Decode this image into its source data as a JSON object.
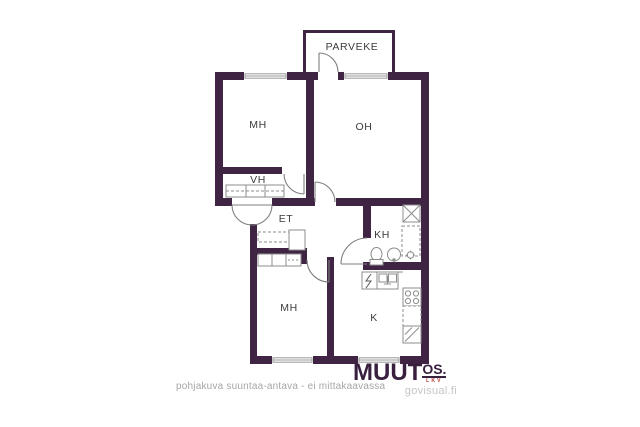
{
  "floor_plan": {
    "rooms": [
      {
        "key": "parveke",
        "label": "PARVEKE"
      },
      {
        "key": "mh_top",
        "label": "MH"
      },
      {
        "key": "oh",
        "label": "OH"
      },
      {
        "key": "vh",
        "label": "VH"
      },
      {
        "key": "et",
        "label": "ET"
      },
      {
        "key": "kh",
        "label": "KH"
      },
      {
        "key": "mh_bottom",
        "label": "MH"
      },
      {
        "key": "k",
        "label": "K"
      }
    ],
    "colors": {
      "wall": "#3f2543",
      "fixture_line": "#8c8c8c",
      "door_line": "#7f7f7f",
      "label": "#3c3c3c"
    },
    "fixture_icons": [
      "wardrobe-icon",
      "entry-door-arc",
      "door-arc",
      "window-symbol",
      "washing-machine-icon",
      "toilet-icon",
      "sink-icon",
      "floor-drain-icon",
      "electrical-cabinet-icon",
      "kitchen-sink-icon",
      "stove-icon",
      "refrigerator-icon"
    ]
  },
  "footer": {
    "disclaimer": "pohjakuva suuntaa-antava - ei mittakaavassa",
    "disclaimer_color": "#a8a4a8"
  },
  "branding": {
    "logo_text": "MUUT",
    "logo_suffix": "OS.",
    "logo_tagline": "LKV",
    "website": "govisual.fi",
    "logo_color": "#39203f",
    "tagline_color": "#b5362e",
    "website_color": "#c8c4c8"
  }
}
